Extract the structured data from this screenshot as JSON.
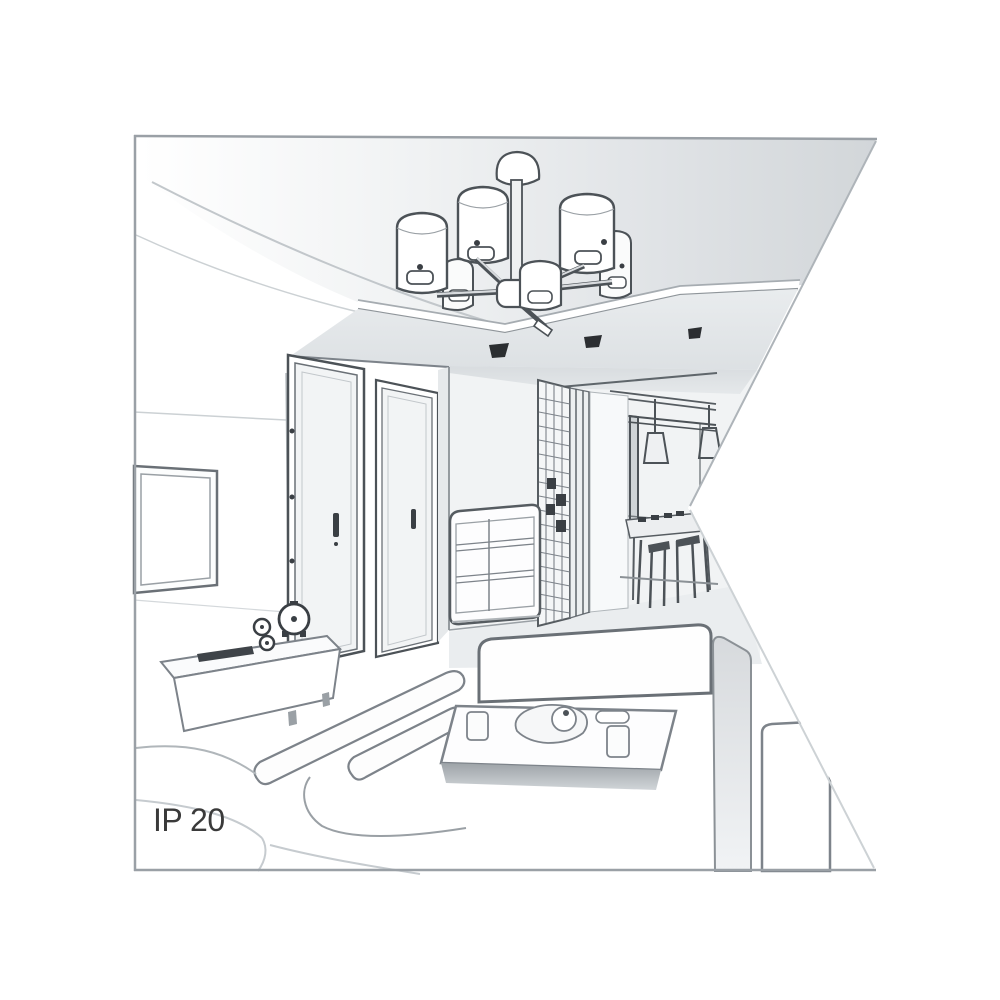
{
  "illustration": {
    "alt": "Grayscale perspective line drawing of a living room interior: ceiling chandelier with six cylindrical shades on a suspended ceiling panel, wall TV, sideboard with clock and speakers, two doors, chest of drawers, slatted wardrobe, hallway with pendant cone lamps and dining set, white sofas around a coffee table. A white triangular wedge is cut into the right edge of the picture.",
    "ip_rating_label": "IP 20"
  },
  "colors": {
    "background": "#ffffff",
    "frame_border": "#9aa0a6",
    "line_dark": "#4c5257",
    "line_medium": "#6a7076",
    "line_soft": "#b8bec3",
    "ceiling_gray": "#d2d6d9",
    "spotlight_dark": "#2b2e31",
    "label_text": "#3a3a3a"
  }
}
